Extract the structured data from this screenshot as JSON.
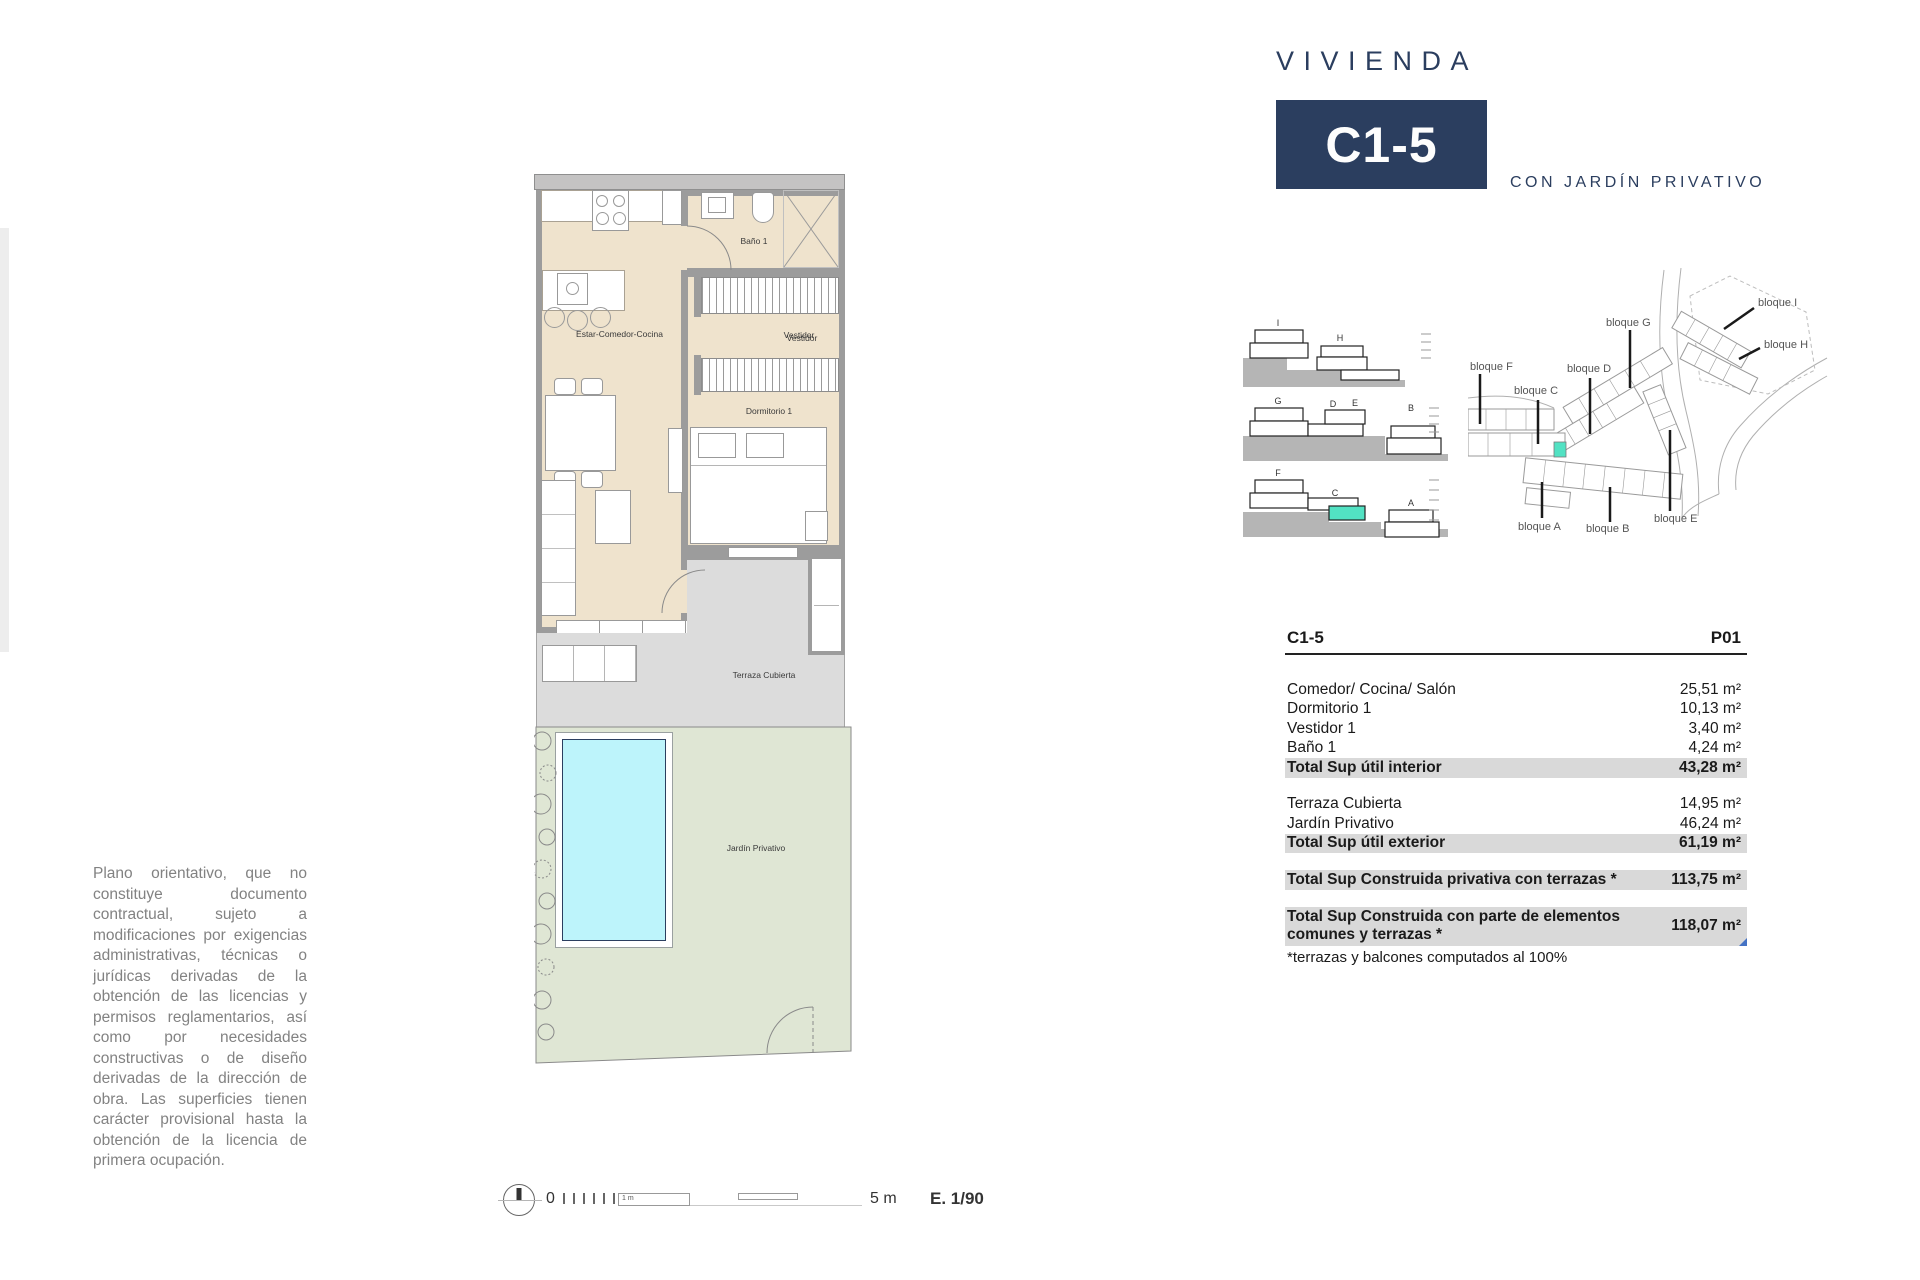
{
  "header": {
    "title": "VIVIENDA",
    "unit": "C1-5",
    "subtitle": "CON JARDÍN PRIVATIVO"
  },
  "plan": {
    "labels": {
      "living": "Estar-Comedor-Cocina",
      "bath": "Baño 1",
      "dressing": "Vestidor",
      "bedroom": "Dormitorio 1",
      "terrace": "Terraza Cubierta",
      "garden": "Jardín Privativo"
    }
  },
  "sections": {
    "letters": [
      "I",
      "H",
      "G",
      "D",
      "E",
      "B",
      "F",
      "C",
      "A"
    ]
  },
  "site": {
    "labels": [
      "bloque I",
      "bloque H",
      "bloque G",
      "bloque D",
      "bloque F",
      "bloque C",
      "bloque A",
      "bloque B",
      "bloque E"
    ]
  },
  "area_table": {
    "unit": "C1-5",
    "floor": "P01",
    "interior_rows": [
      {
        "label": "Comedor/ Cocina/ Salón",
        "value": "25,51 m²"
      },
      {
        "label": "Dormitorio 1",
        "value": "10,13 m²"
      },
      {
        "label": "Vestidor 1",
        "value": "3,40 m²"
      },
      {
        "label": "Baño 1",
        "value": "4,24 m²"
      }
    ],
    "interior_total": {
      "label": "Total Sup útil interior",
      "value": "43,28 m²"
    },
    "exterior_rows": [
      {
        "label": "Terraza Cubierta",
        "value": "14,95 m²"
      },
      {
        "label": "Jardín Privativo",
        "value": "46,24 m²"
      }
    ],
    "exterior_total": {
      "label": "Total Sup útil exterior",
      "value": "61,19 m²"
    },
    "built_private": {
      "label": "Total Sup Construida privativa con terrazas *",
      "value": "113,75 m²"
    },
    "built_common": {
      "label": "Total Sup Construida con parte de elementos comunes y terrazas *",
      "value": "118,07 m²"
    },
    "footnote": "*terrazas y balcones computados al 100%"
  },
  "disclaimer": "Plano orientativo, que no constituye documento contractual, sujeto a modificaciones por exigencias administrativas, técnicas o jurídicas derivadas de la obtención de las licencias y permisos reglamentarios, así como por necesidades constructivas o de diseño derivadas de la dirección de obra. Las superficies tienen carácter provisional hasta la obtención de la licencia de primera ocupación.",
  "scale_bar": {
    "zero": "0",
    "first_meter": "1 m",
    "end": "5 m",
    "ratio": "E. 1/90"
  },
  "colors": {
    "navy": "#2b3e5f",
    "highlight": "#52e2c3",
    "interior": "#efe3cd",
    "terrace": "#dcdcdc",
    "garden": "#dfe6d4",
    "pool": "#bdf4fb",
    "total_row_bg": "#d9d9d9"
  }
}
